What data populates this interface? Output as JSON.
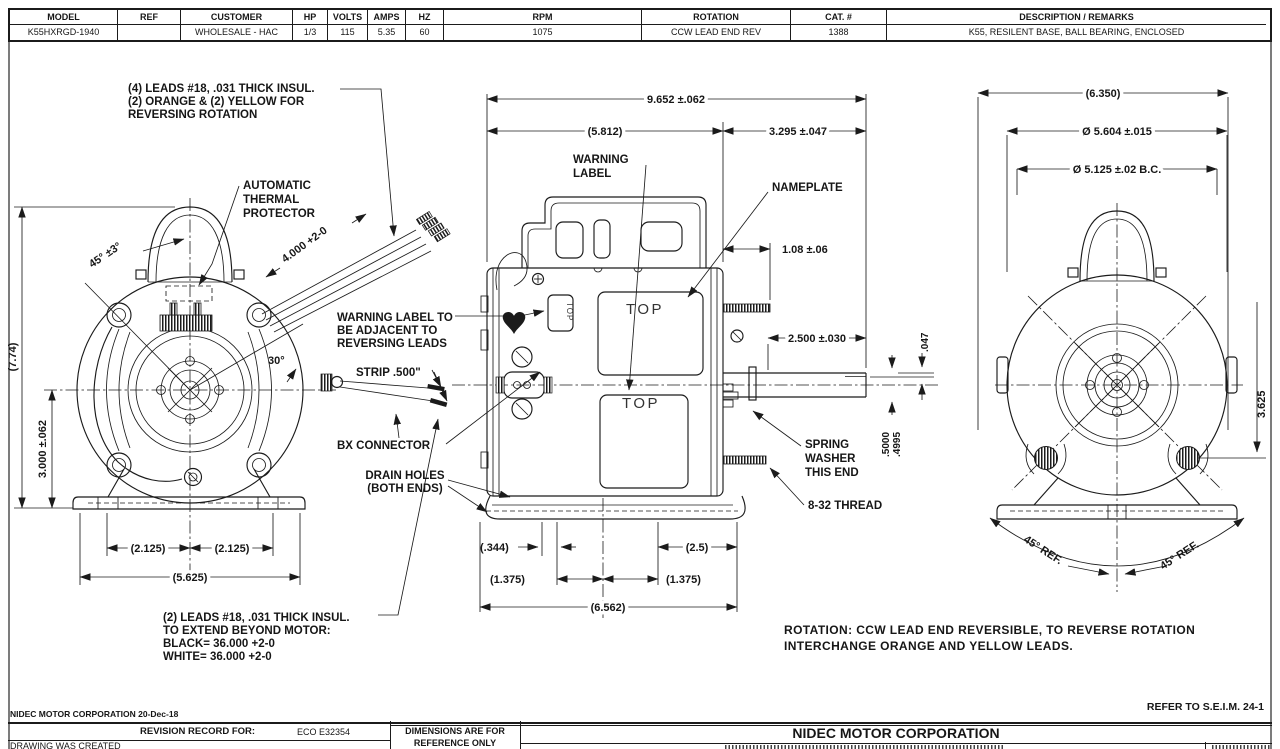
{
  "spec_table": {
    "headers": [
      "MODEL",
      "REF",
      "CUSTOMER",
      "HP",
      "VOLTS",
      "AMPS",
      "HZ",
      "RPM",
      "ROTATION",
      "CAT. #",
      "DESCRIPTION / REMARKS"
    ],
    "values": [
      "K55HXRGD-1940",
      "",
      "WHOLESALE - HAC",
      "1/3",
      "115",
      "5.35",
      "60",
      "1075",
      "CCW LEAD END REV",
      "1388",
      "K55, RESILENT BASE, BALL BEARING, ENCLOSED"
    ]
  },
  "left_view": {
    "note_top": [
      "(4) LEADS #18, .031 THICK INSUL.",
      "(2) ORANGE & (2) YELLOW FOR",
      "REVERSING ROTATION"
    ],
    "thermal": [
      "AUTOMATIC",
      "THERMAL",
      "PROTECTOR"
    ],
    "dim_angle45": "45° ±3°",
    "dim_4000": "4.000 +2-0",
    "dim_angle30": "30°",
    "dim_774": "(7.74)",
    "dim_3000": "3.000 ±.062",
    "dim_2125a": "(2.125)",
    "dim_2125b": "(2.125)",
    "dim_5625": "(5.625)",
    "note_bottom": [
      "(2) LEADS #18, .031 THICK INSUL.",
      "TO EXTEND BEYOND MOTOR:",
      "BLACK= 36.000 +2-0",
      "WHITE= 36.000 +2-0"
    ]
  },
  "center_view": {
    "dim_9652": "9.652 ±.062",
    "dim_5812": "(5.812)",
    "dim_3295": "3.295 ±.047",
    "warning": [
      "WARNING",
      "LABEL"
    ],
    "nameplate": "NAMEPLATE",
    "warn_adjacent": [
      "WARNING LABEL TO",
      "BE ADJACENT TO",
      "REVERSING LEADS"
    ],
    "strip": "STRIP .500\"",
    "bx": "BX CONNECTOR",
    "drain": [
      "DRAIN HOLES",
      "(BOTH ENDS)"
    ],
    "top_upper": "TOP",
    "top_lower": "TOP",
    "top_small": "TOP",
    "dim_108": "1.08 ±.06",
    "dim_2500": "2.500 ±.030",
    "dim_047": ".047",
    "dim_dia1": ".5000",
    "dim_dia2": ".4995",
    "spring": [
      "SPRING",
      "WASHER",
      "THIS END"
    ],
    "thread": "8-32 THREAD",
    "dim_344": "(.344)",
    "dim_25": "(2.5)",
    "dim_1375a": "(1.375)",
    "dim_1375b": "(1.375)",
    "dim_6562": "(6.562)"
  },
  "right_view": {
    "dim_6350": "(6.350)",
    "dim_5604": "Ø 5.604 ±.015",
    "dim_5125": "Ø 5.125 ±.02 B.C.",
    "dim_3625": "3.625",
    "ref45_l": "45° REF.",
    "ref45_r": "45° REF."
  },
  "notes": {
    "rotation1": "ROTATION: CCW LEAD END REVERSIBLE, TO REVERSE ROTATION",
    "rotation2": "INTERCHANGE ORANGE AND YELLOW LEADS."
  },
  "footer": {
    "company_date": "NIDEC MOTOR CORPORATION 20-Dec-18",
    "refer": "REFER TO S.E.I.M. 24-1",
    "revision_record": "REVISION RECORD FOR:",
    "eco": "ECO E32354",
    "drawing_created": "DRAWING WAS CREATED",
    "dims_ref1": "DIMENSIONS ARE FOR",
    "dims_ref2": "REFERENCE ONLY",
    "company_title": "NIDEC MOTOR CORPORATION"
  }
}
